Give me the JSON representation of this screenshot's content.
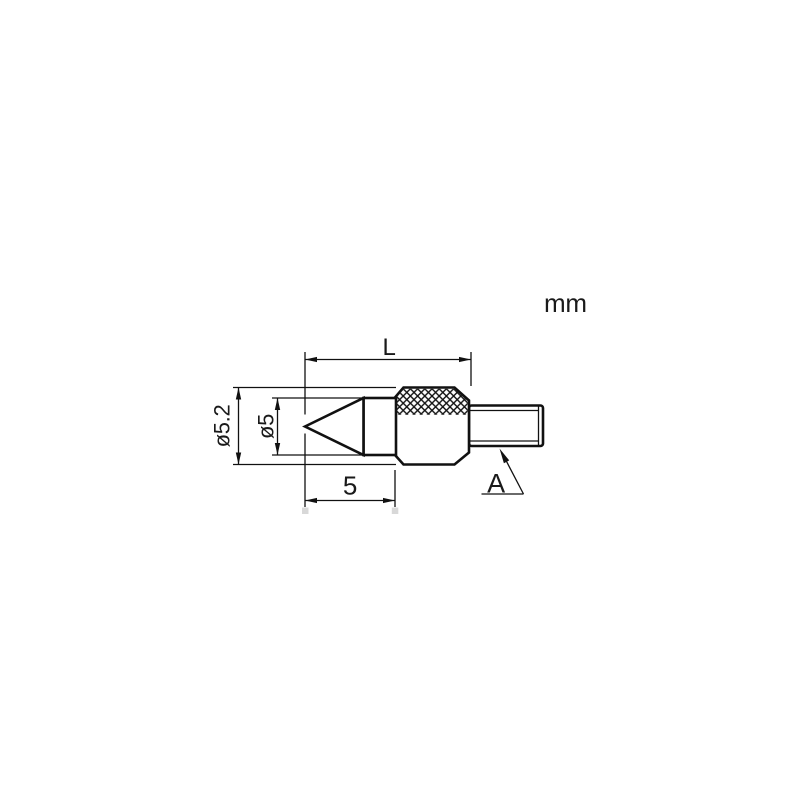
{
  "drawing": {
    "unit_label": "mm",
    "dimensions": {
      "overall_length": "L",
      "tip_length": "5",
      "outer_diameter": "ø5.2",
      "point_base_diameter": "ø5",
      "thread_ref": "A"
    },
    "colors": {
      "line": "#111111",
      "text": "#1a1a1a",
      "background": "#ffffff"
    }
  }
}
